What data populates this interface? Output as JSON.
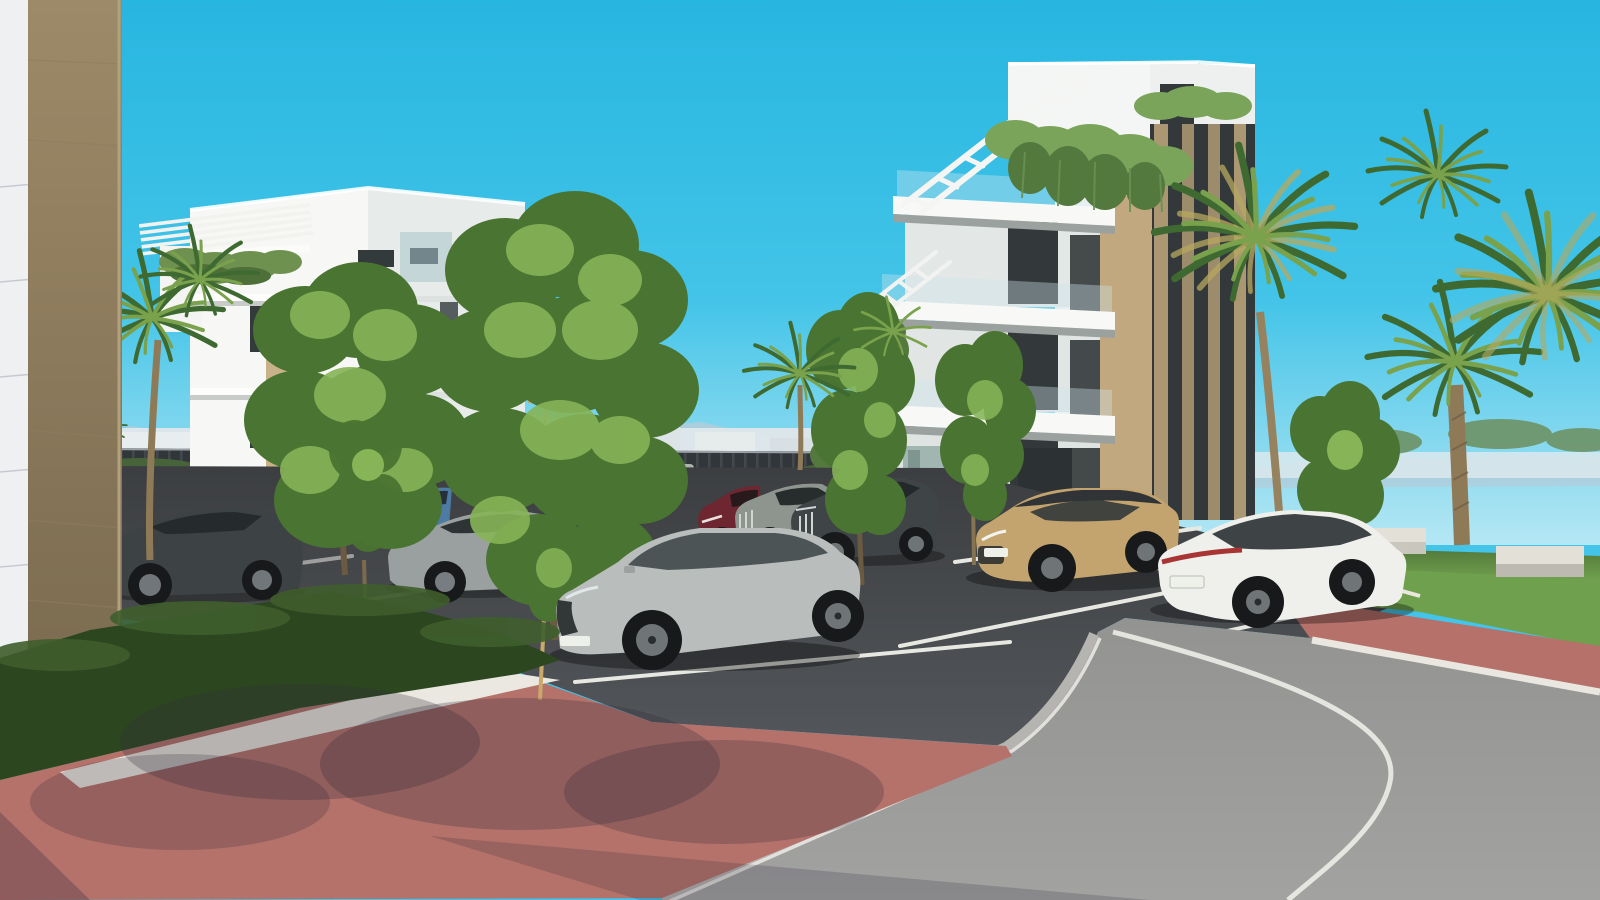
{
  "scene": {
    "type": "architectural-exterior-3d-render",
    "setting": "modern residential complex with parking lot, palm trees and curving road",
    "sky": {
      "top": "#27b6e0",
      "mid": "#43c4e8",
      "horizon": "#b5e7f4"
    },
    "background": {
      "mountains": "#b3ccd8",
      "town_strip": "#dfe7ea",
      "fence": "#31363a",
      "distant_road": "#9a9c9a"
    },
    "buildings": [
      {
        "name": "apartment-block-left",
        "facade_lit": "#f7f8f6",
        "facade_shade": "#e7ebe9",
        "accent": "#c9b28a",
        "glazing": "#323a3c"
      },
      {
        "name": "apartment-block-right",
        "facade_lit": "#f4f6f5",
        "facade_shade": "#eef0ef",
        "wood_accent": "#c2a87e",
        "dark_glazing": "#33383a",
        "balcony_glass": "#cfe6ec"
      }
    ],
    "vegetation": {
      "tree_dark": "#4a7431",
      "tree_light": "#86b457",
      "hedge": "#2c471f",
      "hedge_light": "#46633a",
      "palm_dark": "#3e6a31",
      "palm_light": "#7aa24c",
      "palm_dry": "#b7a95e",
      "grass": "#6fa04e",
      "trunk": "#6b5a42",
      "palm_trunk": "#8f7a58",
      "ivy": "#7ba45b",
      "ivy_dark": "#54793f"
    },
    "ground": {
      "parking_asphalt": "#53565a",
      "road_asphalt": "#939492",
      "brick_paving": "#b5726b",
      "gravel": "#eae8e0",
      "marking": "#e8e8e2",
      "curb": "#e9e7e0",
      "curb_blocks": "#b5b4b0"
    },
    "foreground": {
      "wall_panel": "#eef0f2",
      "stone_column_top": "#9d8a68",
      "stone_column_bottom": "#7b6b50"
    },
    "pool_area": {
      "umbrella": "#f6f6f2",
      "lounger": "#f4f4ee",
      "railing": "#24282a"
    },
    "furniture": {
      "bench": "#e3e0d8"
    },
    "vehicles": [
      {
        "name": "silver-suv-foreground",
        "color": "#b9bdbb"
      },
      {
        "name": "beige-crossover",
        "color": "#c3a46f"
      },
      {
        "name": "white-sedan",
        "color": "#eff0ec"
      },
      {
        "name": "dark-gray-suv",
        "color": "#3f4447"
      },
      {
        "name": "gray-sedan",
        "color": "#8e958f"
      },
      {
        "name": "maroon-crossover",
        "color": "#6e2731"
      },
      {
        "name": "dark-sedan",
        "color": "#3d4245"
      },
      {
        "name": "silver-sedan",
        "color": "#9aa0a0"
      },
      {
        "name": "blue-hatchback",
        "color": "#4e7ba3"
      },
      {
        "name": "distant-silver-car",
        "color": "#c6c9c6"
      }
    ]
  }
}
